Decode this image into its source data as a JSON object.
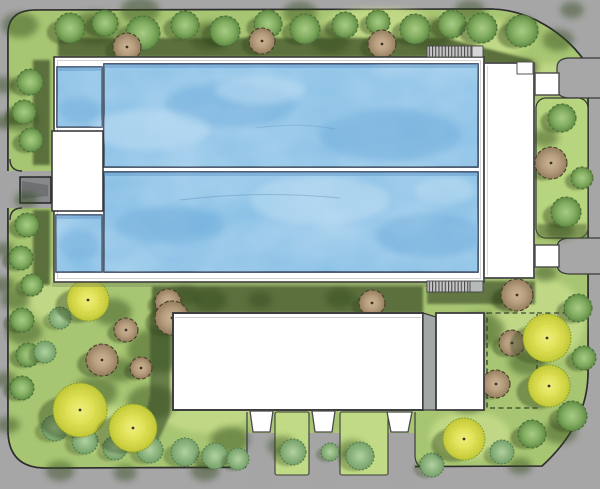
{
  "document": {
    "kind": "architectural-site-plan-rendering",
    "aria_label": "Top-view site plan rendering of an outdoor swimming pool facility with lap pools, pool deck, pavilion buildings, landscaped gardens with trees, and surrounding roads",
    "visible_text": []
  },
  "palette": {
    "road": "#a7a7a7",
    "road_dark": "#87898b",
    "ramp_dark": "#6f7173",
    "grass": "#a9c873",
    "grass_light": "#d6e897",
    "grass_island": "#b7d47e",
    "hedge_dark": "#5b6f3e",
    "boundary_line": "#2e2e2e",
    "water": "#82bce4",
    "water_light": "#bfdff4",
    "water_dark": "#6aa9d8",
    "pool_outline": "#24364f",
    "deck_white": "#ffffff",
    "deck_outline": "#3c3c3c",
    "building_white": "#ffffff",
    "building_outline": "#3e3e3e",
    "building_side_wall": "#a2a8a8",
    "stair_tread": "#c6c6c6",
    "stair_line": "#4a4a4a",
    "tree_green": "#82ad60",
    "tree_yellow": "#dede52",
    "tree_brown": "#b59c7d",
    "bush_green": "#8cb887",
    "canopy_shadow": "#33481e"
  },
  "features": [
    "perimeter-road",
    "site-lawn",
    "lap-pool-upper",
    "lap-pool-lower",
    "plunge-pool-top",
    "plunge-pool-bottom",
    "pool-deck",
    "pool-pavilion-block",
    "west-entrance-ramp",
    "east-building-strip",
    "east-entry-canopy-top",
    "east-entry-canopy-bottom",
    "east-planting-island",
    "top-stairs",
    "bottom-stairs",
    "main-building",
    "building-side-wall",
    "building-annex",
    "future-extension-dashed",
    "entrance-tab-1",
    "entrance-tab-2",
    "entrance-tab-3",
    "south-walkway-1",
    "south-walkway-2",
    "south-walkway-3",
    "garden-trees"
  ],
  "tree_type_legend": {
    "blob": "canopy-shadow-blob",
    "green": "green-deciduous-tree",
    "bush": "low-shrub",
    "brown": "tan-ornamental-tree",
    "yellow": "yellow-flowering-tree"
  },
  "trees": [
    {
      "t": "blob",
      "x": 20,
      "y": 25,
      "r": 14
    },
    {
      "t": "blob",
      "x": 95,
      "y": 28,
      "r": 19
    },
    {
      "t": "blob",
      "x": 140,
      "y": 11,
      "r": 15
    },
    {
      "t": "blob",
      "x": 210,
      "y": 36,
      "r": 16
    },
    {
      "t": "blob",
      "x": 300,
      "y": 13,
      "r": 13
    },
    {
      "t": "blob",
      "x": 330,
      "y": 40,
      "r": 15
    },
    {
      "t": "blob",
      "x": 430,
      "y": 34,
      "r": 17
    },
    {
      "t": "blob",
      "x": 470,
      "y": 11,
      "r": 12
    },
    {
      "t": "blob",
      "x": 520,
      "y": 28,
      "r": 13
    },
    {
      "t": "blob",
      "x": 558,
      "y": 40,
      "r": 12
    },
    {
      "t": "blob",
      "x": 572,
      "y": 10,
      "r": 9
    },
    {
      "t": "blob",
      "x": 4,
      "y": 85,
      "r": 9
    },
    {
      "t": "blob",
      "x": 3,
      "y": 122,
      "r": 8
    },
    {
      "t": "blob",
      "x": 22,
      "y": 120,
      "r": 13
    },
    {
      "t": "blob",
      "x": 26,
      "y": 200,
      "r": 9
    },
    {
      "t": "blob",
      "x": 5,
      "y": 250,
      "r": 8
    },
    {
      "t": "blob",
      "x": 4,
      "y": 285,
      "r": 9
    },
    {
      "t": "blob",
      "x": 15,
      "y": 300,
      "r": 11
    },
    {
      "t": "blob",
      "x": 24,
      "y": 332,
      "r": 14
    },
    {
      "t": "blob",
      "x": 6,
      "y": 380,
      "r": 9
    },
    {
      "t": "blob",
      "x": 8,
      "y": 425,
      "r": 9
    },
    {
      "t": "blob",
      "x": 160,
      "y": 350,
      "r": 25
    },
    {
      "t": "blob",
      "x": 195,
      "y": 330,
      "r": 17
    },
    {
      "t": "blob",
      "x": 112,
      "y": 312,
      "r": 15
    },
    {
      "t": "blob",
      "x": 95,
      "y": 392,
      "r": 17
    },
    {
      "t": "blob",
      "x": 152,
      "y": 402,
      "r": 19
    },
    {
      "t": "blob",
      "x": 210,
      "y": 300,
      "r": 13
    },
    {
      "t": "blob",
      "x": 230,
      "y": 440,
      "r": 15
    },
    {
      "t": "blob",
      "x": 120,
      "y": 370,
      "r": 13
    },
    {
      "t": "blob",
      "x": 185,
      "y": 295,
      "r": 11
    },
    {
      "t": "blob",
      "x": 260,
      "y": 300,
      "r": 9
    },
    {
      "t": "blob",
      "x": 340,
      "y": 298,
      "r": 11
    },
    {
      "t": "blob",
      "x": 282,
      "y": 446,
      "r": 11
    },
    {
      "t": "blob",
      "x": 352,
      "y": 450,
      "r": 11
    },
    {
      "t": "blob",
      "x": 60,
      "y": 471,
      "r": 11
    },
    {
      "t": "blob",
      "x": 125,
      "y": 473,
      "r": 9
    },
    {
      "t": "blob",
      "x": 205,
      "y": 471,
      "r": 11
    },
    {
      "t": "blob",
      "x": 520,
      "y": 466,
      "r": 9
    },
    {
      "t": "blob",
      "x": 480,
      "y": 330,
      "r": 19
    },
    {
      "t": "blob",
      "x": 528,
      "y": 362,
      "r": 15
    },
    {
      "t": "blob",
      "x": 468,
      "y": 402,
      "r": 13
    },
    {
      "t": "blob",
      "x": 560,
      "y": 432,
      "r": 13
    },
    {
      "t": "blob",
      "x": 505,
      "y": 300,
      "r": 11
    },
    {
      "t": "blob",
      "x": 545,
      "y": 138,
      "r": 10
    },
    {
      "t": "blob",
      "x": 560,
      "y": 230,
      "r": 11
    },
    {
      "t": "blob",
      "x": 527,
      "y": 68,
      "r": 9
    },
    {
      "t": "blob",
      "x": 545,
      "y": 273,
      "r": 9
    },
    {
      "t": "green",
      "x": 70,
      "y": 28,
      "r": 15
    },
    {
      "t": "green",
      "x": 105,
      "y": 23,
      "r": 13
    },
    {
      "t": "green",
      "x": 143,
      "y": 33,
      "r": 17
    },
    {
      "t": "green",
      "x": 185,
      "y": 25,
      "r": 14
    },
    {
      "t": "green",
      "x": 225,
      "y": 31,
      "r": 15
    },
    {
      "t": "green",
      "x": 268,
      "y": 24,
      "r": 14
    },
    {
      "t": "green",
      "x": 305,
      "y": 29,
      "r": 15
    },
    {
      "t": "green",
      "x": 345,
      "y": 25,
      "r": 13
    },
    {
      "t": "green",
      "x": 378,
      "y": 22,
      "r": 12
    },
    {
      "t": "green",
      "x": 415,
      "y": 29,
      "r": 15
    },
    {
      "t": "green",
      "x": 452,
      "y": 24,
      "r": 14
    },
    {
      "t": "green",
      "x": 482,
      "y": 28,
      "r": 15
    },
    {
      "t": "green",
      "x": 522,
      "y": 31,
      "r": 16
    },
    {
      "t": "green",
      "x": 30,
      "y": 82,
      "r": 13
    },
    {
      "t": "green",
      "x": 24,
      "y": 112,
      "r": 12
    },
    {
      "t": "green",
      "x": 31,
      "y": 140,
      "r": 12
    },
    {
      "t": "green",
      "x": 27,
      "y": 225,
      "r": 12
    },
    {
      "t": "green",
      "x": 21,
      "y": 258,
      "r": 12
    },
    {
      "t": "green",
      "x": 32,
      "y": 285,
      "r": 11
    },
    {
      "t": "green",
      "x": 22,
      "y": 320,
      "r": 12
    },
    {
      "t": "green",
      "x": 28,
      "y": 355,
      "r": 12
    },
    {
      "t": "green",
      "x": 22,
      "y": 388,
      "r": 12
    },
    {
      "t": "green",
      "x": 562,
      "y": 118,
      "r": 14
    },
    {
      "t": "green",
      "x": 566,
      "y": 212,
      "r": 15
    },
    {
      "t": "green",
      "x": 582,
      "y": 178,
      "r": 11
    },
    {
      "t": "green",
      "x": 578,
      "y": 308,
      "r": 14
    },
    {
      "t": "green",
      "x": 584,
      "y": 358,
      "r": 12
    },
    {
      "t": "green",
      "x": 572,
      "y": 416,
      "r": 15
    },
    {
      "t": "green",
      "x": 532,
      "y": 434,
      "r": 14
    },
    {
      "t": "bush",
      "x": 55,
      "y": 428,
      "r": 13
    },
    {
      "t": "bush",
      "x": 85,
      "y": 441,
      "r": 13
    },
    {
      "t": "bush",
      "x": 115,
      "y": 448,
      "r": 12
    },
    {
      "t": "bush",
      "x": 150,
      "y": 450,
      "r": 13
    },
    {
      "t": "bush",
      "x": 185,
      "y": 452,
      "r": 14
    },
    {
      "t": "bush",
      "x": 215,
      "y": 456,
      "r": 13
    },
    {
      "t": "bush",
      "x": 238,
      "y": 459,
      "r": 11
    },
    {
      "t": "bush",
      "x": 60,
      "y": 318,
      "r": 11
    },
    {
      "t": "bush",
      "x": 45,
      "y": 352,
      "r": 11
    },
    {
      "t": "bush",
      "x": 293,
      "y": 452,
      "r": 13
    },
    {
      "t": "bush",
      "x": 360,
      "y": 456,
      "r": 14
    },
    {
      "t": "bush",
      "x": 330,
      "y": 452,
      "r": 9
    },
    {
      "t": "bush",
      "x": 502,
      "y": 452,
      "r": 12
    },
    {
      "t": "bush",
      "x": 432,
      "y": 465,
      "r": 12
    },
    {
      "t": "brown",
      "x": 127,
      "y": 47,
      "r": 14
    },
    {
      "t": "brown",
      "x": 262,
      "y": 41,
      "r": 13
    },
    {
      "t": "brown",
      "x": 382,
      "y": 44,
      "r": 14
    },
    {
      "t": "brown",
      "x": 168,
      "y": 302,
      "r": 13
    },
    {
      "t": "brown",
      "x": 372,
      "y": 303,
      "r": 13
    },
    {
      "t": "brown",
      "x": 126,
      "y": 330,
      "r": 12
    },
    {
      "t": "brown",
      "x": 102,
      "y": 360,
      "r": 16
    },
    {
      "t": "brown",
      "x": 141,
      "y": 368,
      "r": 11
    },
    {
      "t": "brown",
      "x": 172,
      "y": 318,
      "r": 17
    },
    {
      "t": "brown",
      "x": 517,
      "y": 295,
      "r": 16
    },
    {
      "t": "brown",
      "x": 512,
      "y": 343,
      "r": 13
    },
    {
      "t": "brown",
      "x": 496,
      "y": 384,
      "r": 14
    },
    {
      "t": "brown",
      "x": 551,
      "y": 163,
      "r": 16
    },
    {
      "t": "yellow",
      "x": 88,
      "y": 300,
      "r": 21
    },
    {
      "t": "yellow",
      "x": 80,
      "y": 410,
      "r": 27
    },
    {
      "t": "yellow",
      "x": 133,
      "y": 428,
      "r": 24
    },
    {
      "t": "yellow",
      "x": 547,
      "y": 338,
      "r": 24
    },
    {
      "t": "yellow",
      "x": 549,
      "y": 386,
      "r": 21
    },
    {
      "t": "yellow",
      "x": 464,
      "y": 439,
      "r": 21
    }
  ]
}
